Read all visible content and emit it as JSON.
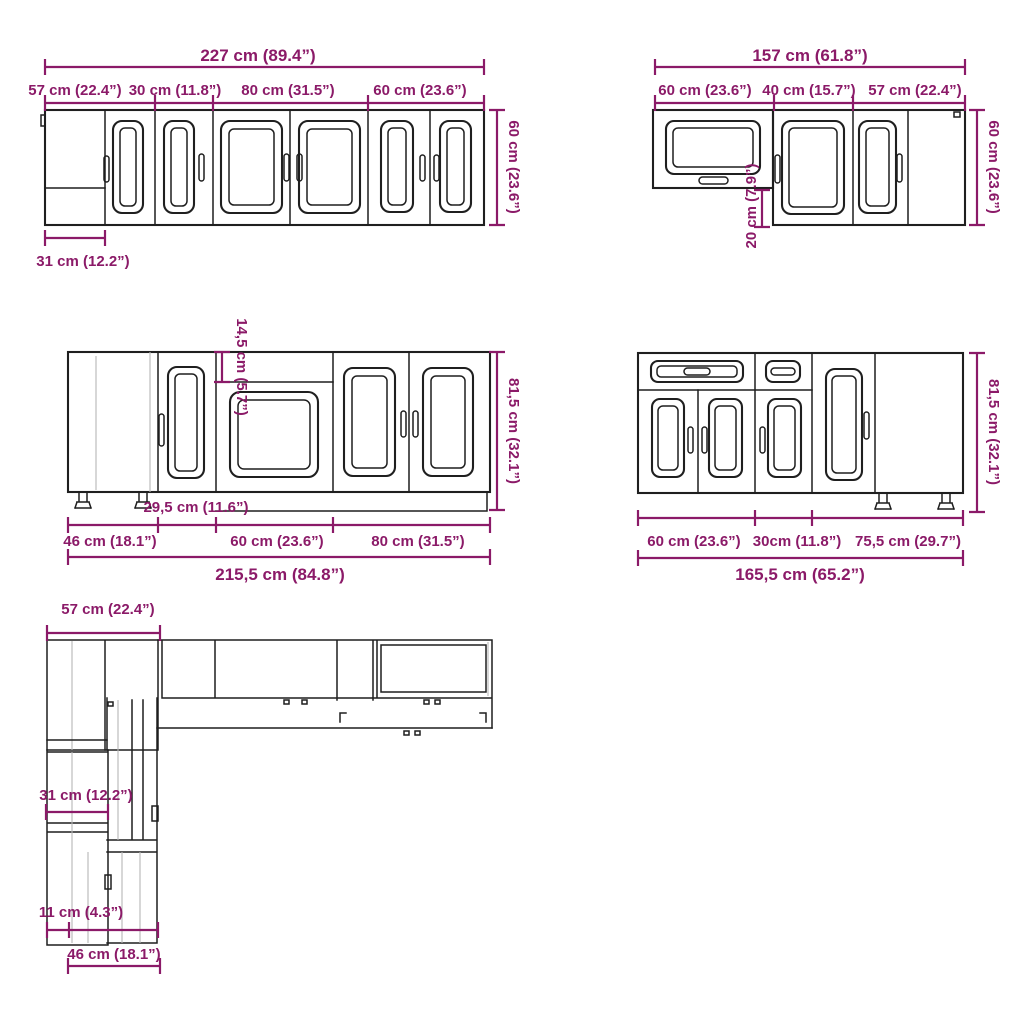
{
  "colors": {
    "dimension": "#8B1A68",
    "line": "#1f1f1f",
    "faint": "#b6b6b6",
    "background": "#ffffff"
  },
  "wall_left": {
    "total": "227 cm (89.4”)",
    "seg1": "57 cm (22.4”)",
    "seg2": "30 cm (11.8”)",
    "seg3": "80 cm (31.5”)",
    "seg4": "60 cm (23.6”)",
    "height": "60 cm (23.6”)",
    "depth": "31 cm (12.2”)"
  },
  "wall_right": {
    "total": "157 cm (61.8”)",
    "seg1": "60 cm (23.6”)",
    "seg2": "40 cm (15.7”)",
    "seg3": "57 cm (22.4”)",
    "height": "60 cm (23.6”)",
    "gap": "20 cm (7.9”)"
  },
  "base_left": {
    "total": "215,5 cm (84.8”)",
    "seg1": "46 cm (18.1”)",
    "seg2": "60 cm (23.6”)",
    "seg3": "80 cm (31.5”)",
    "inner": "29,5 cm (11.6”)",
    "height": "81,5 cm (32.1”)",
    "gap": "14,5 cm (5.7”)"
  },
  "base_right": {
    "total": "165,5 cm (65.2”)",
    "seg1": "60 cm (23.6”)",
    "seg2": "30cm (11.8”)",
    "seg3": "75,5 cm (29.7”)",
    "height": "81,5 cm (32.1”)"
  },
  "plan": {
    "width_top": "57 cm (22.4”)",
    "width_mid": "31 cm (12.2”)",
    "width_small": "11 cm (4.3”)",
    "width_bottom": "46 cm (18.1”)"
  }
}
